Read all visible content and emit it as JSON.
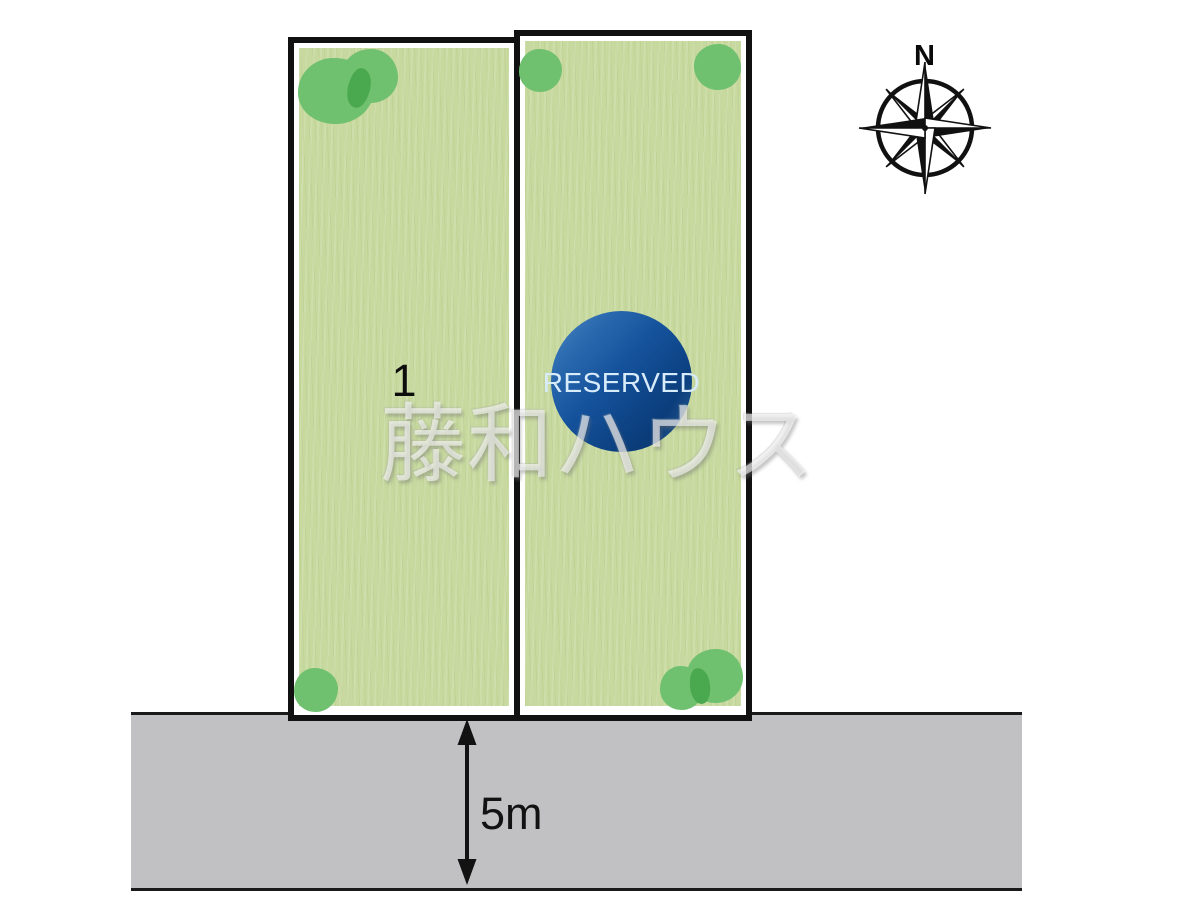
{
  "diagram": {
    "compass_label": "N",
    "watermark_text": "藤和ハウス",
    "road_width_label": "5m",
    "plots": [
      {
        "label": "1",
        "status": "available"
      },
      {
        "label": "",
        "status": "RESERVED"
      }
    ],
    "reserved_badge_text": "RESERVED"
  },
  "colors": {
    "plot_green": "#c7d99e",
    "tree_green": "#6fc06f",
    "tree_overlap_green": "#4aa94e",
    "road_gray": "#c1c1c3",
    "outline_black": "#111111",
    "badge_blue_light": "#4d88c6",
    "badge_blue_dark": "#0a3c79",
    "badge_text_color": "#d7ebfa"
  }
}
